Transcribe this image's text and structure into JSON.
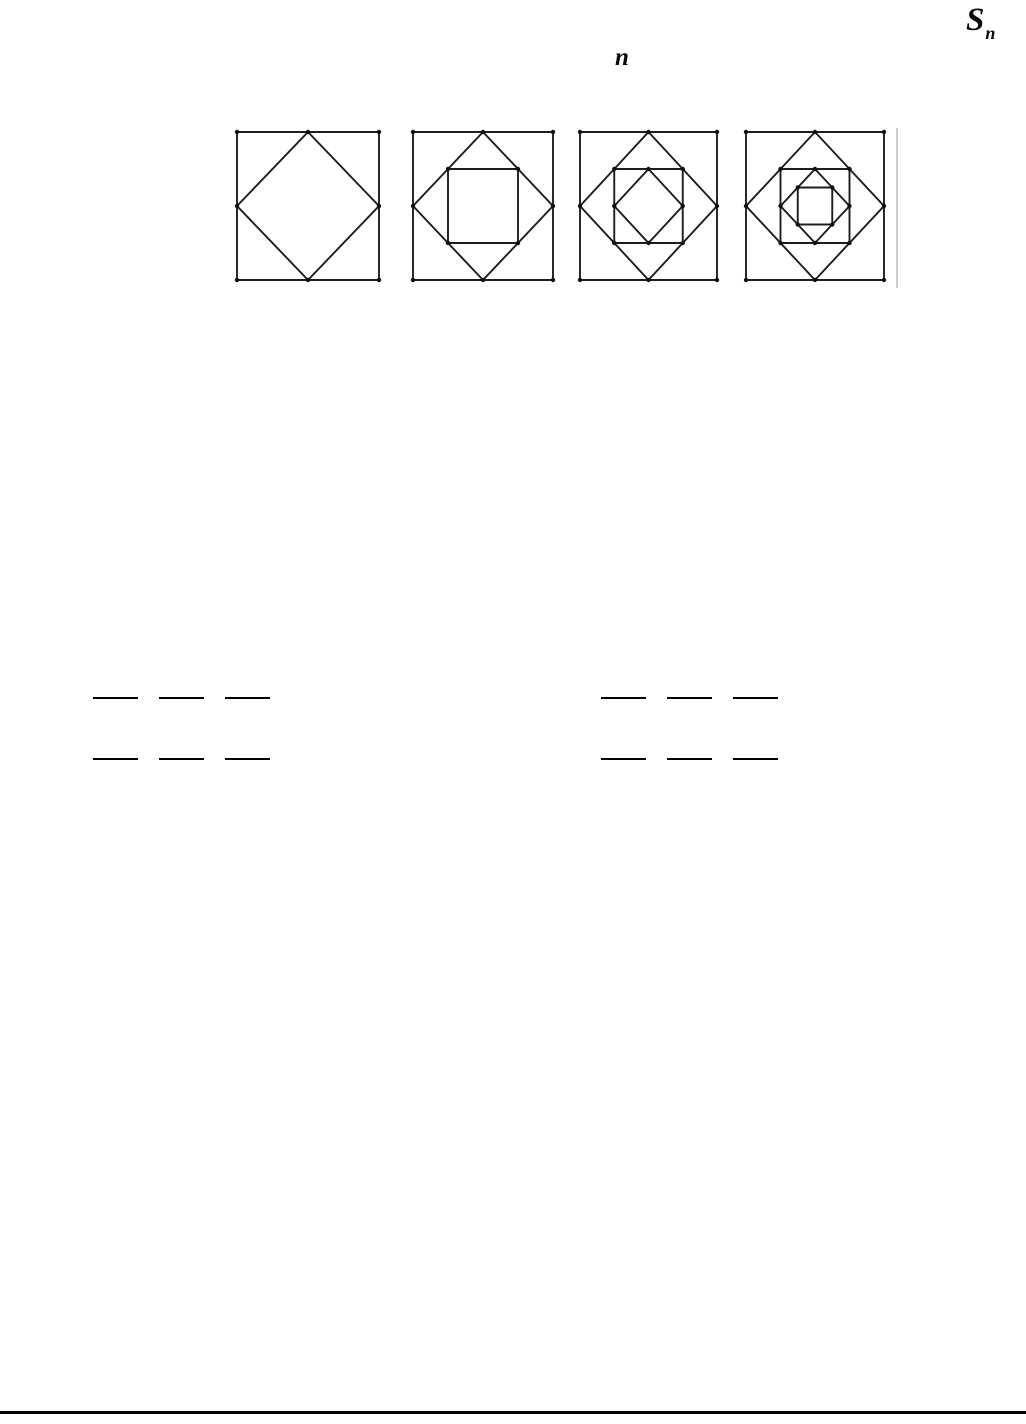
{
  "formula": {
    "base": "S",
    "sub": "n"
  },
  "variable_n": "n",
  "figures": {
    "description": "sequence of nested squares, each inner square joining midpoints of the previous",
    "stroke_color": "#1d1d1d",
    "dot_color": "#111111",
    "items": [
      {
        "name": "figure-1",
        "squares": 2
      },
      {
        "name": "figure-2",
        "squares": 3
      },
      {
        "name": "figure-3",
        "squares": 4
      },
      {
        "name": "figure-4",
        "squares": 5
      }
    ]
  },
  "answer_blanks": {
    "line_color": "#000000",
    "groups": [
      {
        "name": "left-group",
        "rows": 2,
        "blanks_per_row": 3
      },
      {
        "name": "right-group",
        "rows": 2,
        "blanks_per_row": 3
      }
    ]
  },
  "footer_rule_color": "#000000"
}
